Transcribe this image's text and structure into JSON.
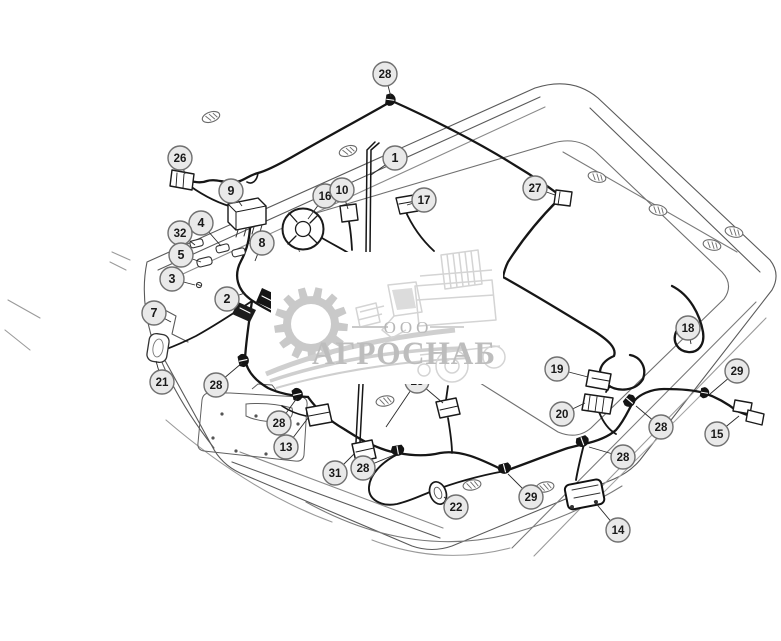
{
  "page": {
    "width": 781,
    "height": 641,
    "background": "#ffffff"
  },
  "diagram": {
    "type": "parts-diagram",
    "subject": "cab-roof-wiring-harness-exploded-view",
    "line_color": "#161616",
    "structure_color": "#5a5a5a",
    "callout_style": {
      "fill": "#e9e9e9",
      "stroke": "#707070",
      "text_color": "#1a1a1a",
      "radius": 12
    },
    "callouts": [
      {
        "label": "28",
        "x": 385,
        "y": 74,
        "leaders": [
          [
            391,
            97
          ]
        ]
      },
      {
        "label": "26",
        "x": 180,
        "y": 158,
        "leaders": [
          [
            185,
            174
          ]
        ]
      },
      {
        "label": "1",
        "x": 395,
        "y": 158,
        "leaders": [
          [
            371,
            175
          ]
        ]
      },
      {
        "label": "9",
        "x": 231,
        "y": 191,
        "leaders": [
          [
            242,
            206
          ]
        ]
      },
      {
        "label": "16",
        "x": 325,
        "y": 196,
        "leaders": [
          [
            308,
            219
          ]
        ]
      },
      {
        "label": "10",
        "x": 342,
        "y": 190,
        "leaders": [
          [
            348,
            209
          ]
        ]
      },
      {
        "label": "17",
        "x": 424,
        "y": 200,
        "leaders": [
          [
            407,
            205
          ]
        ]
      },
      {
        "label": "27",
        "x": 535,
        "y": 188,
        "leaders": [
          [
            555,
            195
          ]
        ]
      },
      {
        "label": "4",
        "x": 201,
        "y": 223,
        "leaders": [
          [
            221,
            246
          ]
        ]
      },
      {
        "label": "32",
        "x": 180,
        "y": 233,
        "leaders": [
          [
            195,
            245
          ]
        ]
      },
      {
        "label": "5",
        "x": 181,
        "y": 255,
        "leaders": [
          [
            201,
            262
          ]
        ]
      },
      {
        "label": "3",
        "x": 172,
        "y": 279,
        "leaders": [
          [
            195,
            285
          ]
        ]
      },
      {
        "label": "8",
        "x": 262,
        "y": 243,
        "leaders": [
          [
            255,
            261
          ]
        ]
      },
      {
        "label": "2",
        "x": 227,
        "y": 299,
        "leaders": [
          [
            245,
            293
          ]
        ]
      },
      {
        "label": "7",
        "x": 154,
        "y": 313,
        "leaders": [
          [
            171,
            322
          ]
        ]
      },
      {
        "label": "21",
        "x": 162,
        "y": 382,
        "leaders": [
          [
            156,
            361
          ]
        ]
      },
      {
        "label": "28",
        "x": 216,
        "y": 385,
        "leaders": [
          [
            242,
            363
          ]
        ]
      },
      {
        "label": "28",
        "x": 279,
        "y": 423,
        "leaders": [
          [
            297,
            398
          ]
        ]
      },
      {
        "label": "13",
        "x": 286,
        "y": 447,
        "leaders": [
          [
            308,
            418
          ]
        ]
      },
      {
        "label": "31",
        "x": 335,
        "y": 473,
        "leaders": [
          [
            354,
            454
          ]
        ]
      },
      {
        "label": "28",
        "x": 363,
        "y": 468,
        "leaders": [
          [
            394,
            455
          ]
        ]
      },
      {
        "label": "23",
        "x": 417,
        "y": 381,
        "leaders": [
          [
            443,
            403
          ],
          [
            386,
            427
          ]
        ],
        "partially_hidden": true
      },
      {
        "label": "22",
        "x": 456,
        "y": 507,
        "leaders": [
          [
            444,
            497
          ]
        ]
      },
      {
        "label": "29",
        "x": 531,
        "y": 497,
        "leaders": [
          [
            508,
            474
          ]
        ]
      },
      {
        "label": "14",
        "x": 618,
        "y": 530,
        "leaders": [
          [
            594,
            501
          ]
        ]
      },
      {
        "label": "28",
        "x": 623,
        "y": 457,
        "leaders": [
          [
            589,
            447
          ]
        ]
      },
      {
        "label": "28",
        "x": 661,
        "y": 427,
        "leaders": [
          [
            636,
            406
          ]
        ]
      },
      {
        "label": "19",
        "x": 557,
        "y": 369,
        "leaders": [
          [
            588,
            377
          ]
        ]
      },
      {
        "label": "20",
        "x": 562,
        "y": 414,
        "leaders": [
          [
            585,
            403
          ]
        ]
      },
      {
        "label": "29",
        "x": 737,
        "y": 371,
        "leaders": [
          [
            710,
            394
          ]
        ]
      },
      {
        "label": "15",
        "x": 717,
        "y": 434,
        "leaders": [
          [
            739,
            416
          ]
        ]
      },
      {
        "label": "18",
        "x": 688,
        "y": 328,
        "leaders": [
          [
            691,
            344
          ]
        ]
      }
    ]
  },
  "watermark": {
    "company_prefix": "ООО",
    "company_name": "АГРОСНАБ",
    "logo_icons": [
      "gear-icon",
      "combine-harvester-icon",
      "swoosh-lines"
    ],
    "text_color": "#bdbdbd",
    "logo_color": "#c9c9c9",
    "panel_color": "#ffffff"
  }
}
